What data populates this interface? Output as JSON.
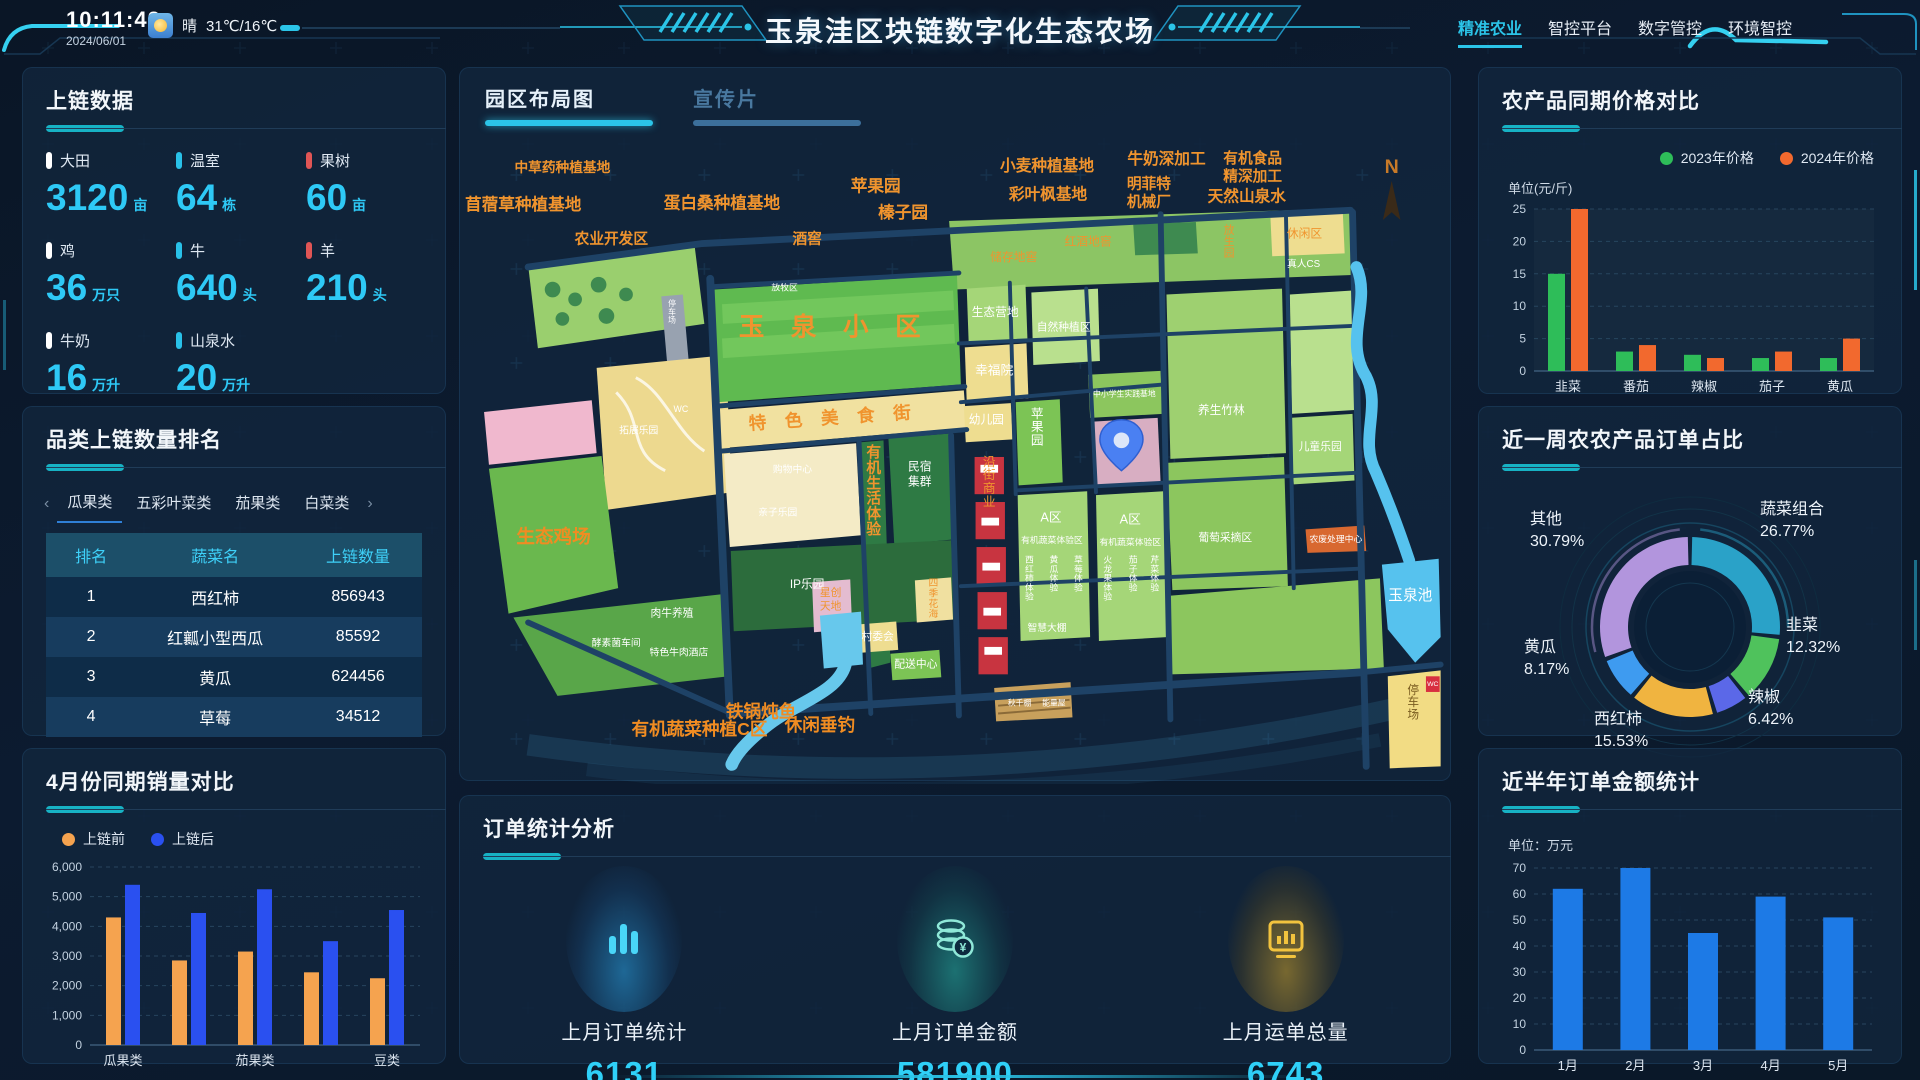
{
  "header": {
    "time": "10:11:42",
    "date": "2024/06/01",
    "weather": {
      "icon": "sun-icon",
      "condition": "晴",
      "temperature": "31℃/16℃"
    },
    "title": "玉泉洼区块链数字化生态农场",
    "nav": [
      {
        "label": "精准农业",
        "active": true
      },
      {
        "label": "智控平台",
        "active": false
      },
      {
        "label": "数字管控",
        "active": false
      },
      {
        "label": "环境智控",
        "active": false
      }
    ]
  },
  "colors": {
    "accent_cyan": "#2bc4e8",
    "value_cyan": "#2ec9f6",
    "title_bar": "#17b2c4",
    "marker_white": "#ffffff",
    "marker_cyan": "#29c1e8",
    "marker_red": "#e05555",
    "bar_orange": "#f5a34f",
    "bar_blue": "#2a50f0",
    "bar_green": "#2ebd59",
    "bar_orange2": "#f2692e",
    "bar_month_blue": "#1d7ae6"
  },
  "panels": {
    "chain_data": {
      "title": "上链数据",
      "items": [
        {
          "label": "大田",
          "value": "3120",
          "unit": "亩",
          "marker": "#ffffff"
        },
        {
          "label": "温室",
          "value": "64",
          "unit": "栋",
          "marker": "#29c1e8"
        },
        {
          "label": "果树",
          "value": "60",
          "unit": "亩",
          "marker": "#e05555"
        },
        {
          "label": "鸡",
          "value": "36",
          "unit": "万只",
          "marker": "#ffffff"
        },
        {
          "label": "牛",
          "value": "640",
          "unit": "头",
          "marker": "#29c1e8"
        },
        {
          "label": "羊",
          "value": "210",
          "unit": "头",
          "marker": "#e05555"
        },
        {
          "label": "牛奶",
          "value": "16",
          "unit": "万升",
          "marker": "#ffffff"
        },
        {
          "label": "山泉水",
          "value": "20",
          "unit": "万升",
          "marker": "#29c1e8"
        }
      ]
    },
    "ranking": {
      "title": "品类上链数量排名",
      "tabs": [
        "瓜果类",
        "五彩叶菜类",
        "茄果类",
        "白菜类"
      ],
      "active_tab": "瓜果类",
      "columns": [
        "排名",
        "蔬菜名",
        "上链数量"
      ],
      "rows": [
        [
          "1",
          "西红柿",
          "856943"
        ],
        [
          "2",
          "红瓤小型西瓜",
          "85592"
        ],
        [
          "3",
          "黄瓜",
          "624456"
        ],
        [
          "4",
          "草莓",
          "34512"
        ]
      ]
    },
    "april_sales": {
      "title": "4月份同期销量对比",
      "chart_data": {
        "type": "bar",
        "categories": [
          "瓜果类",
          "",
          "茄果类",
          "",
          "豆类"
        ],
        "series": [
          {
            "name": "上链前",
            "color": "#f5a34f",
            "values": [
              4300,
              2850,
              3150,
              2450,
              2250
            ]
          },
          {
            "name": "上链后",
            "color": "#2a50f0",
            "values": [
              5400,
              4450,
              5250,
              3500,
              4550
            ]
          }
        ],
        "ylim": [
          0,
          6000
        ],
        "ystep": 1000,
        "grid": "dashed",
        "legend_position": "top-left"
      }
    },
    "map": {
      "tabs": [
        {
          "label": "园区布局图",
          "active": true
        },
        {
          "label": "宣传片",
          "active": false
        }
      ],
      "labels": [
        {
          "t": "中草药种植基地",
          "x": 95,
          "y": 45,
          "s": 14,
          "c": "o",
          "b": 1
        },
        {
          "t": "苜蓿草种植基地",
          "x": 55,
          "y": 84,
          "s": 17,
          "c": "o",
          "b": 1
        },
        {
          "t": "蛋白桑种植基地",
          "x": 258,
          "y": 82,
          "s": 17,
          "c": "o",
          "b": 1
        },
        {
          "t": "农业开发区",
          "x": 145,
          "y": 118,
          "s": 15,
          "c": "o",
          "b": 1
        },
        {
          "t": "酒窖",
          "x": 345,
          "y": 118,
          "s": 15,
          "c": "o",
          "b": 1
        },
        {
          "t": "苹果园",
          "x": 415,
          "y": 65,
          "s": 17,
          "c": "o",
          "b": 1
        },
        {
          "t": "榛子园",
          "x": 443,
          "y": 92,
          "s": 17,
          "c": "o",
          "b": 1
        },
        {
          "t": "小麦种植基地",
          "x": 590,
          "y": 44,
          "s": 16,
          "c": "o",
          "b": 1
        },
        {
          "t": "彩叶枫基地",
          "x": 591,
          "y": 73,
          "s": 16,
          "c": "o",
          "b": 1
        },
        {
          "t": "牛奶深加工",
          "x": 712,
          "y": 37,
          "s": 16,
          "c": "o",
          "b": 1
        },
        {
          "t": "明菲特",
          "x": 694,
          "y": 62,
          "s": 15,
          "c": "o",
          "b": 1
        },
        {
          "t": "机械厂",
          "x": 694,
          "y": 80,
          "s": 15,
          "c": "o",
          "b": 1
        },
        {
          "t": "有机食品",
          "x": 800,
          "y": 36,
          "s": 15,
          "c": "o",
          "b": 1
        },
        {
          "t": "精深加工",
          "x": 800,
          "y": 54,
          "s": 15,
          "c": "o",
          "b": 1
        },
        {
          "t": "天然山泉水",
          "x": 794,
          "y": 75,
          "s": 16,
          "c": "o",
          "b": 1
        },
        {
          "t": "N",
          "x": 942,
          "y": 46,
          "s": 20,
          "c": "#c87a28",
          "b": 1
        },
        {
          "t": "储存地窖",
          "x": 556,
          "y": 136,
          "s": 12,
          "c": "o"
        },
        {
          "t": "红酒地窖",
          "x": 632,
          "y": 120,
          "s": 12,
          "c": "o"
        },
        {
          "t": "休闲区",
          "x": 853,
          "y": 112,
          "s": 12,
          "c": "o"
        },
        {
          "t": "放生园",
          "x": 776,
          "y": 108,
          "s": 11,
          "c": "o",
          "v": 1
        },
        {
          "t": "真人CS",
          "x": 852,
          "y": 142,
          "s": 10,
          "c": "w"
        },
        {
          "t": "玉 泉 小 区",
          "x": 373,
          "y": 212,
          "s": 26,
          "c": "o",
          "b": 1,
          "ls": 10
        },
        {
          "t": "特 色 美 食 街",
          "x": 372,
          "y": 302,
          "s": 18,
          "c": "o",
          "b": 1,
          "ls": 7,
          "r": -4
        },
        {
          "t": "有机生活体验",
          "x": 413,
          "y": 336,
          "s": 15,
          "c": "o",
          "b": 1,
          "v": 1
        },
        {
          "t": "民宿",
          "x": 460,
          "y": 350,
          "s": 12,
          "c": "w"
        },
        {
          "t": "集群",
          "x": 460,
          "y": 365,
          "s": 12,
          "c": "w"
        },
        {
          "t": "购物中心",
          "x": 330,
          "y": 352,
          "s": 10,
          "c": "w"
        },
        {
          "t": "亲子乐园",
          "x": 315,
          "y": 396,
          "s": 10,
          "c": "w"
        },
        {
          "t": "IP乐园",
          "x": 345,
          "y": 470,
          "s": 12,
          "c": "w"
        },
        {
          "t": "放牧区",
          "x": 322,
          "y": 166,
          "s": 9,
          "c": "w"
        },
        {
          "t": "沿街商业",
          "x": 531,
          "y": 345,
          "s": 13,
          "c": "o",
          "v": 1
        },
        {
          "t": "生态营地",
          "x": 537,
          "y": 192,
          "s": 12,
          "c": "w"
        },
        {
          "t": "自然种植区",
          "x": 607,
          "y": 207,
          "s": 11,
          "c": "w"
        },
        {
          "t": "幸福院",
          "x": 536,
          "y": 252,
          "s": 13,
          "c": "w"
        },
        {
          "t": "幼儿园",
          "x": 528,
          "y": 302,
          "s": 12,
          "c": "w"
        },
        {
          "t": "苹果园",
          "x": 580,
          "y": 296,
          "s": 13,
          "c": "w",
          "v": 1
        },
        {
          "t": "中小学生实践基地",
          "x": 669,
          "y": 274,
          "s": 8,
          "c": "w"
        },
        {
          "t": "A区",
          "x": 594,
          "y": 402,
          "s": 13,
          "c": "w"
        },
        {
          "t": "有机蔬菜体验区",
          "x": 595,
          "y": 424,
          "s": 9,
          "c": "w"
        },
        {
          "t": "A区",
          "x": 675,
          "y": 404,
          "s": 13,
          "c": "w"
        },
        {
          "t": "有机蔬菜体验区",
          "x": 675,
          "y": 426,
          "s": 9,
          "c": "w"
        },
        {
          "t": "西红柿体验",
          "x": 572,
          "y": 444,
          "s": 9,
          "c": "w",
          "v": 1
        },
        {
          "t": "黄瓜体验",
          "x": 597,
          "y": 444,
          "s": 9,
          "c": "w",
          "v": 1
        },
        {
          "t": "草莓体验",
          "x": 622,
          "y": 444,
          "s": 9,
          "c": "w",
          "v": 1
        },
        {
          "t": "火龙果体验",
          "x": 652,
          "y": 444,
          "s": 9,
          "c": "w",
          "v": 1
        },
        {
          "t": "茄子体验",
          "x": 678,
          "y": 444,
          "s": 9,
          "c": "w",
          "v": 1
        },
        {
          "t": "芹菜体验",
          "x": 700,
          "y": 444,
          "s": 9,
          "c": "w",
          "v": 1
        },
        {
          "t": "养生竹林",
          "x": 768,
          "y": 292,
          "s": 12,
          "c": "w"
        },
        {
          "t": "儿童乐园",
          "x": 869,
          "y": 329,
          "s": 11,
          "c": "w"
        },
        {
          "t": "葡萄采摘区",
          "x": 772,
          "y": 422,
          "s": 11,
          "c": "w"
        },
        {
          "t": "农废处理中心",
          "x": 885,
          "y": 423,
          "s": 9,
          "c": "w"
        },
        {
          "t": "智慧大棚",
          "x": 590,
          "y": 514,
          "s": 10,
          "c": "w"
        },
        {
          "t": "村委会",
          "x": 417,
          "y": 523,
          "s": 11,
          "c": "w"
        },
        {
          "t": "配送中心",
          "x": 456,
          "y": 551,
          "s": 11,
          "c": "w"
        },
        {
          "t": "四季花海",
          "x": 474,
          "y": 468,
          "s": 10,
          "c": "o",
          "v": 1
        },
        {
          "t": "星创",
          "x": 369,
          "y": 478,
          "s": 11,
          "c": "o"
        },
        {
          "t": "天地",
          "x": 369,
          "y": 492,
          "s": 11,
          "c": "o"
        },
        {
          "t": "肉牛养殖",
          "x": 207,
          "y": 499,
          "s": 11,
          "c": "w"
        },
        {
          "t": "特色牛肉酒店",
          "x": 214,
          "y": 539,
          "s": 10,
          "c": "w"
        },
        {
          "t": "酵素菌车间",
          "x": 150,
          "y": 529,
          "s": 10,
          "c": "w"
        },
        {
          "t": "生态鸡场",
          "x": 86,
          "y": 424,
          "s": 19,
          "c": "ob",
          "b": 1
        },
        {
          "t": "玉泉池",
          "x": 961,
          "y": 482,
          "s": 15,
          "c": "w"
        },
        {
          "t": "WC",
          "x": 984,
          "y": 570,
          "s": 7,
          "c": "w"
        },
        {
          "t": "停车场",
          "x": 964,
          "y": 578,
          "s": 12,
          "c": "br",
          "v": 1
        },
        {
          "t": "秋千棚",
          "x": 562,
          "y": 590,
          "s": 8,
          "c": "w"
        },
        {
          "t": "能量屋",
          "x": 597,
          "y": 590,
          "s": 8,
          "c": "w"
        },
        {
          "t": "停车场",
          "x": 207,
          "y": 182,
          "s": 8,
          "c": "w",
          "v": 1
        },
        {
          "t": "WC",
          "x": 216,
          "y": 290,
          "s": 9,
          "c": "w"
        },
        {
          "t": "拓展乐园",
          "x": 173,
          "y": 312,
          "s": 10,
          "c": "w"
        },
        {
          "t": "铁锅炖鱼",
          "x": 298,
          "y": 602,
          "s": 18,
          "c": "ob",
          "b": 1
        },
        {
          "t": "休闲垂钓",
          "x": 358,
          "y": 616,
          "s": 18,
          "c": "ob",
          "b": 1
        },
        {
          "t": "有机蔬菜种植C区",
          "x": 235,
          "y": 620,
          "s": 18,
          "c": "ob",
          "b": 1
        }
      ]
    },
    "order_stats": {
      "title": "订单统计分析",
      "items": [
        {
          "icon": "bar-chart-icon",
          "label": "上月订单统计",
          "value": "6131"
        },
        {
          "icon": "coins-icon",
          "label": "上月订单金额",
          "value": "581900"
        },
        {
          "icon": "monitor-icon",
          "label": "上月运单总量",
          "value": "6743"
        }
      ]
    },
    "price_compare": {
      "title": "农产品同期价格对比",
      "unit": "单位(元/斤)",
      "chart_data": {
        "type": "bar",
        "categories": [
          "韭菜",
          "番茄",
          "辣椒",
          "茄子",
          "黄瓜"
        ],
        "series": [
          {
            "name": "2023年价格",
            "color": "#2ebd59",
            "values": [
              15,
              3,
              2.5,
              2,
              2
            ]
          },
          {
            "name": "2024年价格",
            "color": "#f2692e",
            "values": [
              25,
              4,
              2,
              3,
              5
            ]
          }
        ],
        "ylim": [
          0,
          25
        ],
        "ystep": 5,
        "grid": "dashed",
        "legend_position": "top-right"
      }
    },
    "order_share": {
      "title": "近一周农农产品订单占比",
      "chart_data": {
        "type": "pie",
        "segments": [
          {
            "name": "蔬菜组合",
            "pct": 26.77,
            "color": "#2aa2c8"
          },
          {
            "name": "韭菜",
            "pct": 12.32,
            "color": "#4fc25c"
          },
          {
            "name": "辣椒",
            "pct": 6.42,
            "color": "#5b68e8"
          },
          {
            "name": "西红柿",
            "pct": 15.53,
            "color": "#f0b440"
          },
          {
            "name": "黄瓜",
            "pct": 8.17,
            "color": "#3e9bf0"
          },
          {
            "name": "其他",
            "pct": 30.79,
            "color": "#b295dd"
          }
        ],
        "label_pos": [
          {
            "x": 258,
            "y": 24
          },
          {
            "x": 284,
            "y": 140
          },
          {
            "x": 246,
            "y": 212
          },
          {
            "x": 92,
            "y": 234
          },
          {
            "x": 22,
            "y": 162
          },
          {
            "x": 28,
            "y": 34
          }
        ]
      }
    },
    "half_year": {
      "title": "近半年订单金额统计",
      "unit": "单位：万元",
      "chart_data": {
        "type": "bar",
        "categories": [
          "1月",
          "2月",
          "3月",
          "4月",
          "5月"
        ],
        "series": [
          {
            "name": "订单金额",
            "color": "#1d7ae6",
            "values": [
              62,
              70,
              45,
              59,
              51
            ]
          }
        ],
        "ylim": [
          0,
          70
        ],
        "ystep": 10,
        "grid": "dashed"
      }
    }
  }
}
